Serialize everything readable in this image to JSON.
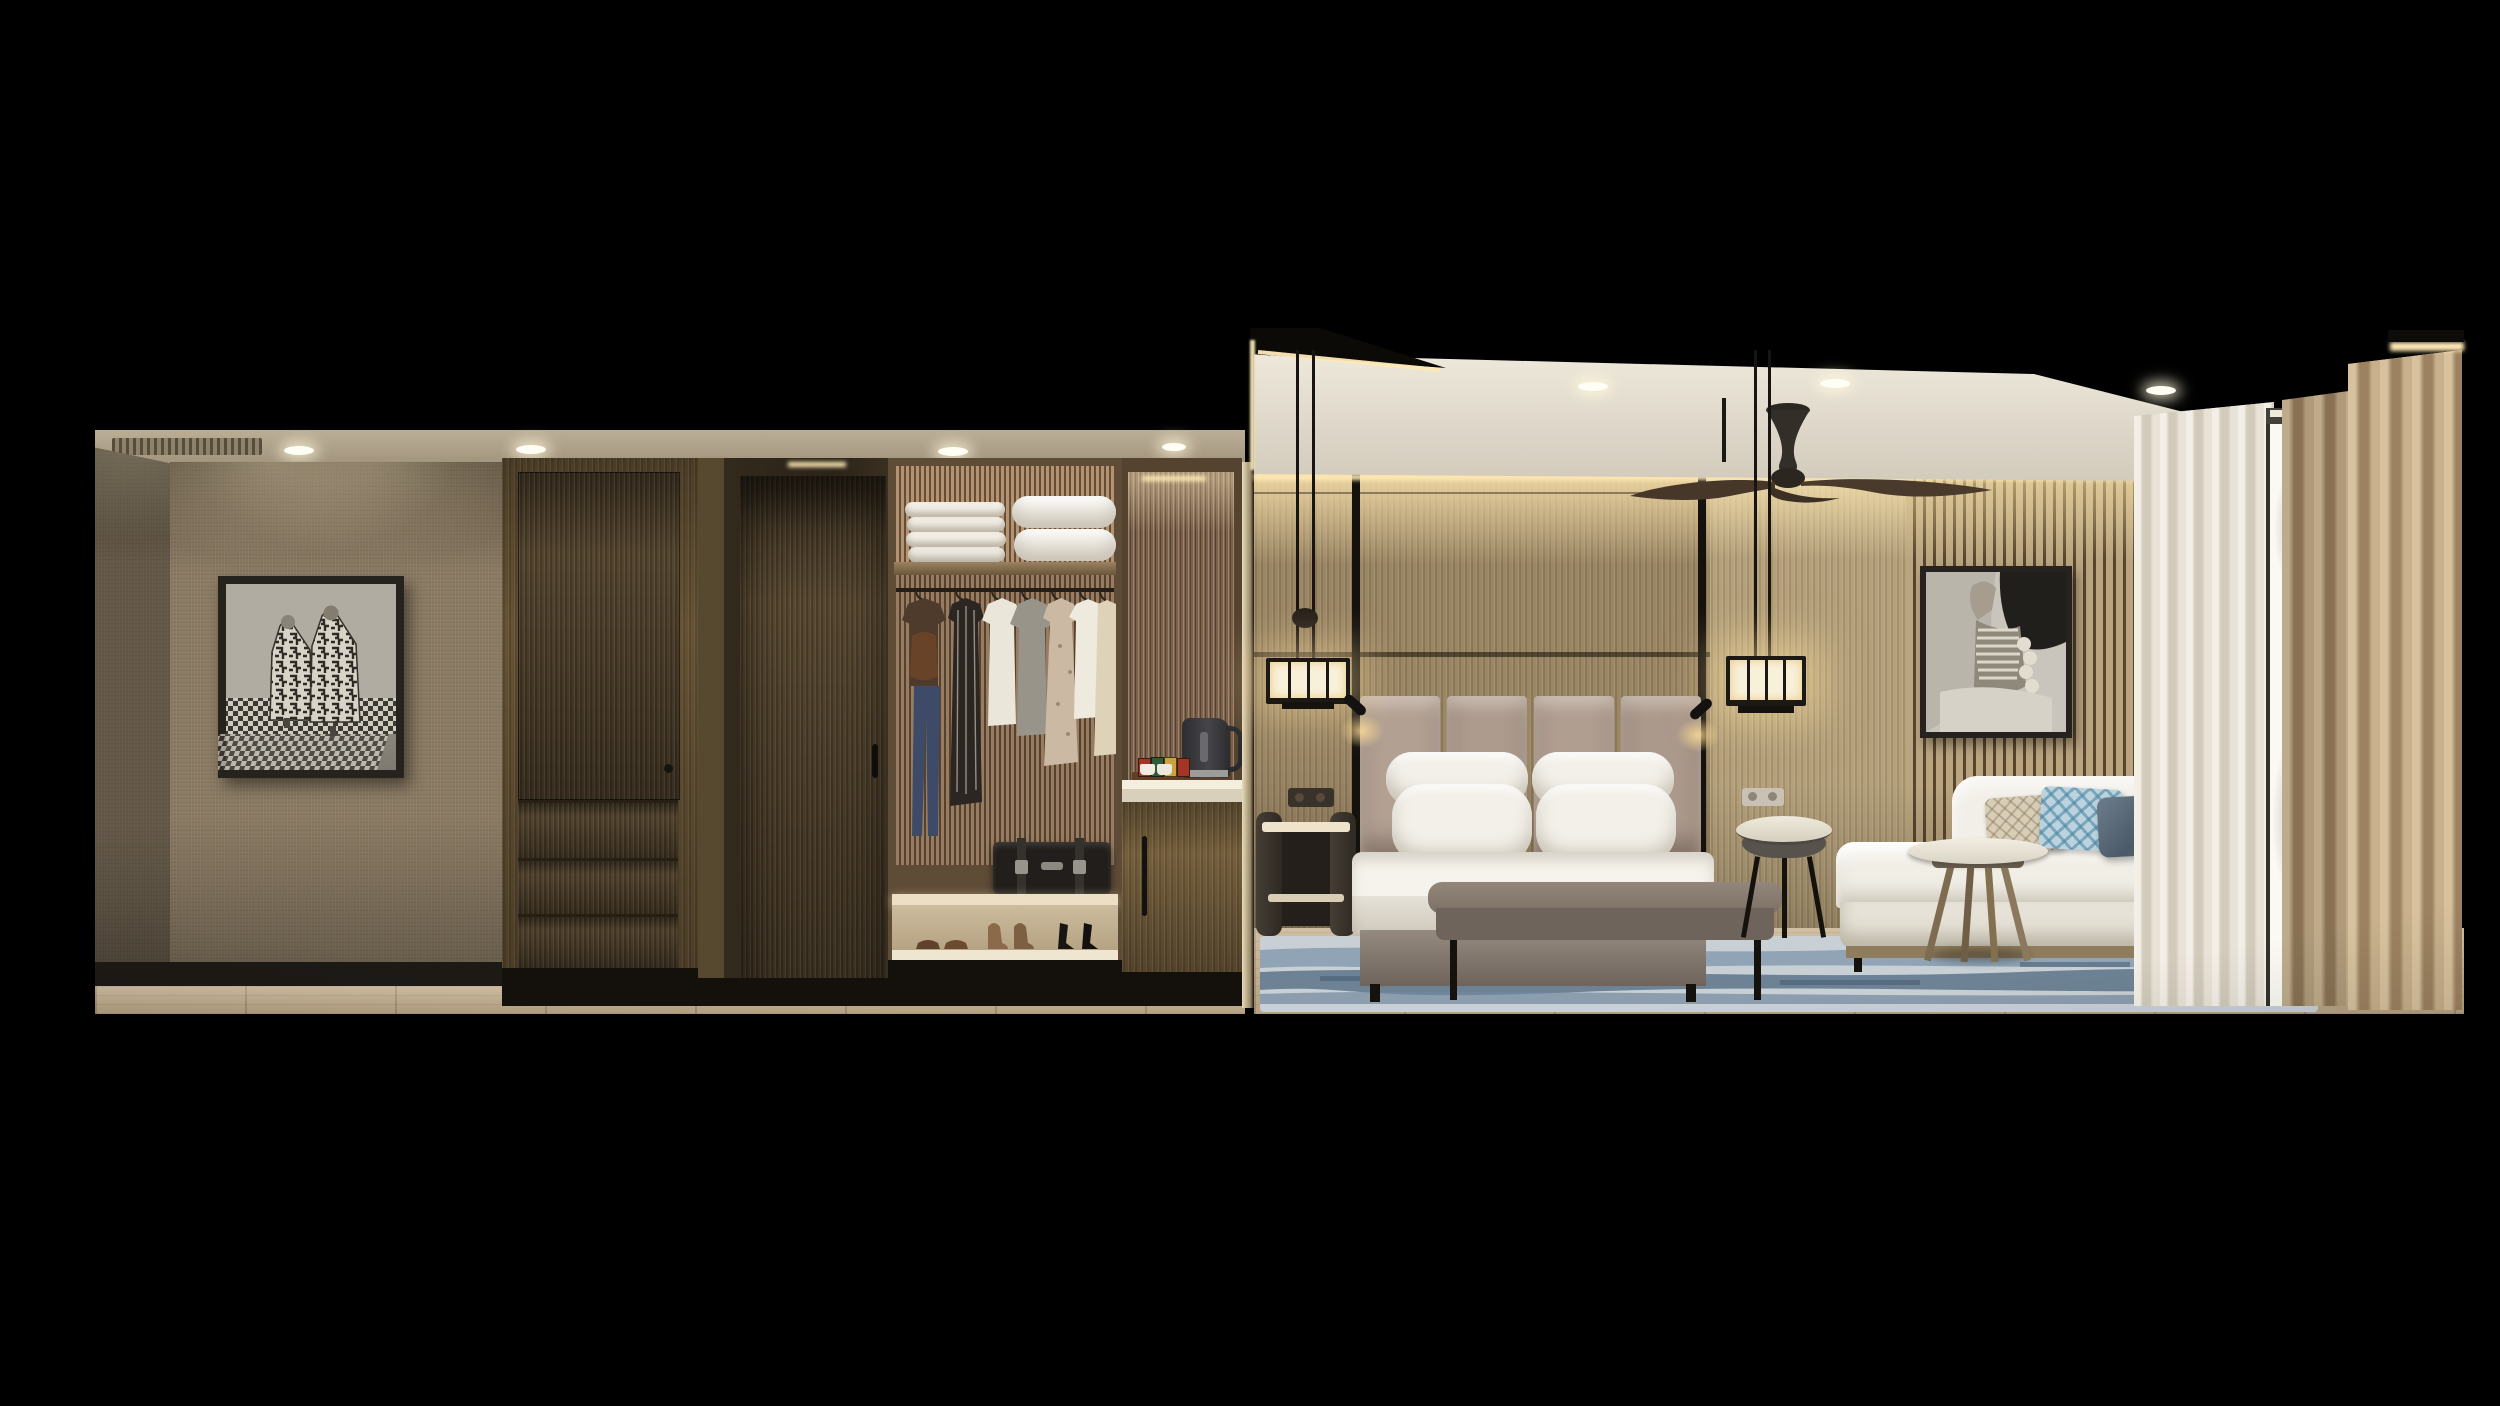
{
  "meta": {
    "domain": "natural-image",
    "description": "Photorealistic cutaway rendering of a hotel guest room: entry corridor with framed artwork, wood wardrobe, entry door alcove, open closet with linens and clothes, minibar counter, and bedroom with upholstered headboard wall, king bed, pendant lights, ceiling fan, lounge sofa, coffee table, blue rug and floor-to-ceiling sheer-curtained window."
  },
  "palette": {
    "background": "#000000",
    "wallpaper": "#8a7a63",
    "wood_dark": "#4c3e2a",
    "wood_mid": "#665335",
    "slat_wall": "#ab9672",
    "ceiling_bedroom": "#e9e3d6",
    "cove_glow": "#ffe9b4",
    "linen_white": "#f3f0e9",
    "headboard_taupe": "#b2a093",
    "bench_leather": "#877a70",
    "sofa_boucle": "#f1eee6",
    "rug_blue": "#6d8296",
    "rug_base": "#c8d0d6",
    "drape_tan": "#bda684",
    "sheer": "#e6e0d4",
    "floor_oak": "#c7b190",
    "cushion_blue": "#7fa5ba",
    "cushion_slate": "#5c6c7a",
    "cushion_beige": "#d8cdb6",
    "kettle_black": "#37373a",
    "suitcase_black": "#211e1b"
  },
  "labels": {
    "stage": "hotel room cutaway rendering",
    "corridor": "entry corridor with wallpaper wall",
    "artwork_left": "framed black and white photo of two figures in patterned Kuba cloth",
    "wardrobe": "wood wardrobe with door and four drawers",
    "door": "entry door alcove with dark wood door",
    "closet": "open closet with towels, pillows, hanging clothes, suitcase and shoes",
    "minibar": "minibar cabinet with kettle, cups and tea sachets",
    "bedroom": "bedroom with wood panel walls and cove lighting",
    "ceiling": "white ceiling with recessed downlights",
    "fan": "dark ceiling fan",
    "pendant_left": "left lantern pendant light",
    "pendant_right": "right lantern pendant light",
    "headboard": "upholstered headboard panels",
    "bed": "king bed with white linens and four pillows",
    "bench": "leather bench at foot of bed",
    "nightstand": "dark leather nightstand",
    "side_table": "round drum side table",
    "artwork_right": "framed black and white tribal portrait photo",
    "sofa": "white boucle lounge sofa with three cushions",
    "coffee_table": "round coffee table with splayed wood legs",
    "rug": "abstract blue area rug",
    "window": "floor-to-ceiling window with sheer curtains",
    "drapes": "tan blackout drapes",
    "outlet": "wall power outlet",
    "reading_light": "headboard reading spotlight"
  }
}
